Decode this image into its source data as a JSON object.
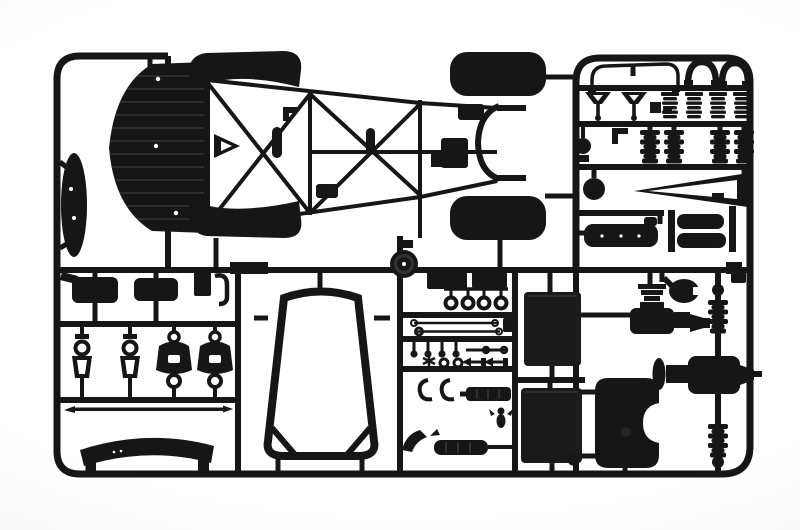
{
  "scene": {
    "type": "photograph",
    "subject": "Black injection-molded styrene sprue (parts tree) from a scale racing-car model kit, shot on a white studio backdrop",
    "aria_label": "Photograph of a black plastic model-kit sprue holding a space-frame chassis with nose tray and four fenders, a windscreen frame, suspension uprights, springs, bellows boots, radiators, gearbox units and a fuel tank"
  },
  "colors": {
    "plastic": "#161616",
    "plastic_panel": "#1b1b1b",
    "rib_highlight": "#333333",
    "tick_highlight": "#3a3a3a",
    "hole": "#ffffff",
    "backdrop": "#ffffff",
    "vignette": "#e6e6e6"
  },
  "sprue": {
    "material": "black styrene",
    "sections": [
      {
        "id": "main",
        "name": "chassis and body section",
        "parts": [
          "ribbed nose floor tray",
          "tubular space-frame chassis",
          "front wheel-arch fenders (2)",
          "rear wheel-arch fenders (2)",
          "rear bulkhead hoop",
          "side sill panel (oval)",
          "pulley disc"
        ]
      },
      {
        "id": "top-right",
        "name": "suspension detail section",
        "parts": [
          "anti-roll bar",
          "arch brackets (2)",
          "suspension forks (2)",
          "coil-spring dampers (4)",
          "rubber bellows boots (4)",
          "ball joint",
          "narrow A-arm wishbone",
          "cam cover",
          "muffler boxes (2)"
        ]
      },
      {
        "id": "bottom-left",
        "name": "underbody section",
        "parts": [
          "oil tanks (2)",
          "clip block with hook",
          "open suspension uprights (2)",
          "bell suspension uprights (2)",
          "tie rod",
          "cockpit cowl"
        ]
      },
      {
        "id": "bottom-center",
        "name": "windscreen section",
        "parts": [
          "windscreen frame with corner braces"
        ]
      },
      {
        "id": "bottom-middle",
        "name": "fittings section",
        "parts": [
          "mounting plates (2)",
          "towing rings (4)",
          "steering rods (2)",
          "mushroom pegs (4)",
          "ball linkage rod",
          "star wheel",
          "eyelets (2)",
          "studs (2)",
          "C-clips (2)",
          "ribbed sleeve",
          "winged pin",
          "exhaust tailpipe",
          "radiator cores (2)"
        ]
      },
      {
        "id": "bottom-right",
        "name": "drivetrain section",
        "parts": [
          "differential gearbox units (2)",
          "filler cap",
          "notched fuel tank",
          "drive shaft with bellows boots"
        ]
      }
    ]
  }
}
